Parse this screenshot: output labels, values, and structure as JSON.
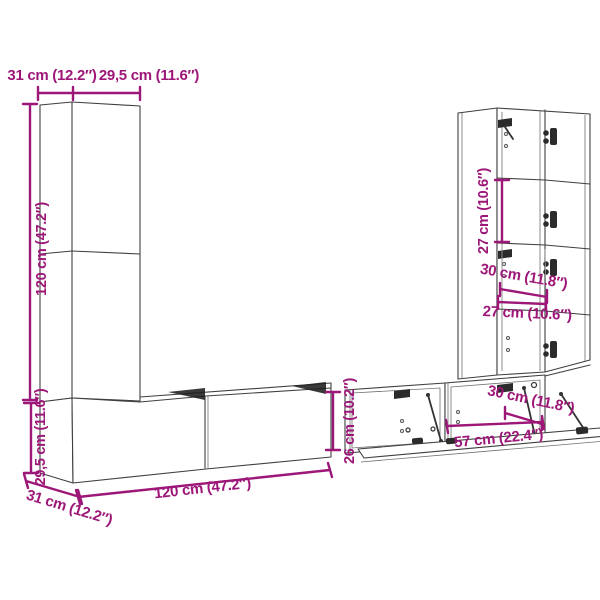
{
  "page": {
    "background": "#FFFFFF"
  },
  "style": {
    "dimension_color": "#9D1778",
    "line_color": "#3F3F3F",
    "shadow_color": "#1E1E1E"
  },
  "diagram": {
    "type": "furniture-dimension-diagram",
    "subject": "wall-mounted TV cabinet set with tall cabinets, wall benches and drop-flap units",
    "labels": {
      "top_depth": "31 cm (12.2″)",
      "top_width": "29,5 cm (11.6″)",
      "left_height": "120 cm (47.2″)",
      "bench_height": "29,5 cm (11.6″)",
      "bench_depth": "31 cm (12.2″)",
      "bench_width": "120 cm (47.2″)",
      "open_unit_height": "26 cm (10.2″)",
      "compartment_height": "27 cm (10.6″)",
      "cabinet_depth": "30 cm (11.8″)",
      "compartment_width": "27 cm (10.6″)",
      "flap_depth": "30 cm (11.8″)",
      "flap_width": "57 cm (22.4″)"
    },
    "measurements": [
      {
        "part": "tall cabinet depth",
        "cm": "31",
        "inches": "12.2"
      },
      {
        "part": "tall cabinet width",
        "cm": "29,5",
        "inches": "11.6"
      },
      {
        "part": "tall cabinet height",
        "cm": "120",
        "inches": "47.2"
      },
      {
        "part": "bench height",
        "cm": "29,5",
        "inches": "11.6"
      },
      {
        "part": "bench depth",
        "cm": "31",
        "inches": "12.2"
      },
      {
        "part": "bench width",
        "cm": "120",
        "inches": "47.2"
      },
      {
        "part": "open unit height",
        "cm": "26",
        "inches": "10.2"
      },
      {
        "part": "compartment height",
        "cm": "27",
        "inches": "10.6"
      },
      {
        "part": "cabinet depth",
        "cm": "30",
        "inches": "11.8"
      },
      {
        "part": "compartment width",
        "cm": "27",
        "inches": "10.6"
      },
      {
        "part": "flap depth",
        "cm": "30",
        "inches": "11.8"
      },
      {
        "part": "flap width",
        "cm": "57",
        "inches": "22.4"
      }
    ]
  }
}
